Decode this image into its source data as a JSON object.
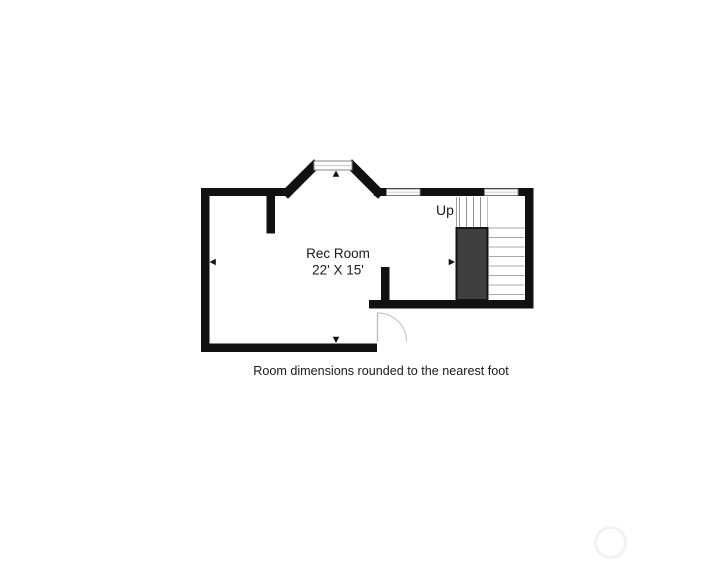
{
  "floorplan": {
    "room": {
      "label": "Rec Room",
      "dimensions": "22' X 15'"
    },
    "stairs": {
      "label": "Up"
    },
    "caption": "Room dimensions rounded to the nearest foot",
    "colors": {
      "wall": "#111111",
      "stair_enclosure_fill": "#3f3f3f",
      "tread_line": "#a8a8a8",
      "window_fill": "#fcfcfc",
      "window_border": "#8a8a8a",
      "door_swing": "#c9c9c9",
      "text": "#1a1a1a",
      "background": "#ffffff",
      "watermark": "#f2f2f2"
    }
  }
}
